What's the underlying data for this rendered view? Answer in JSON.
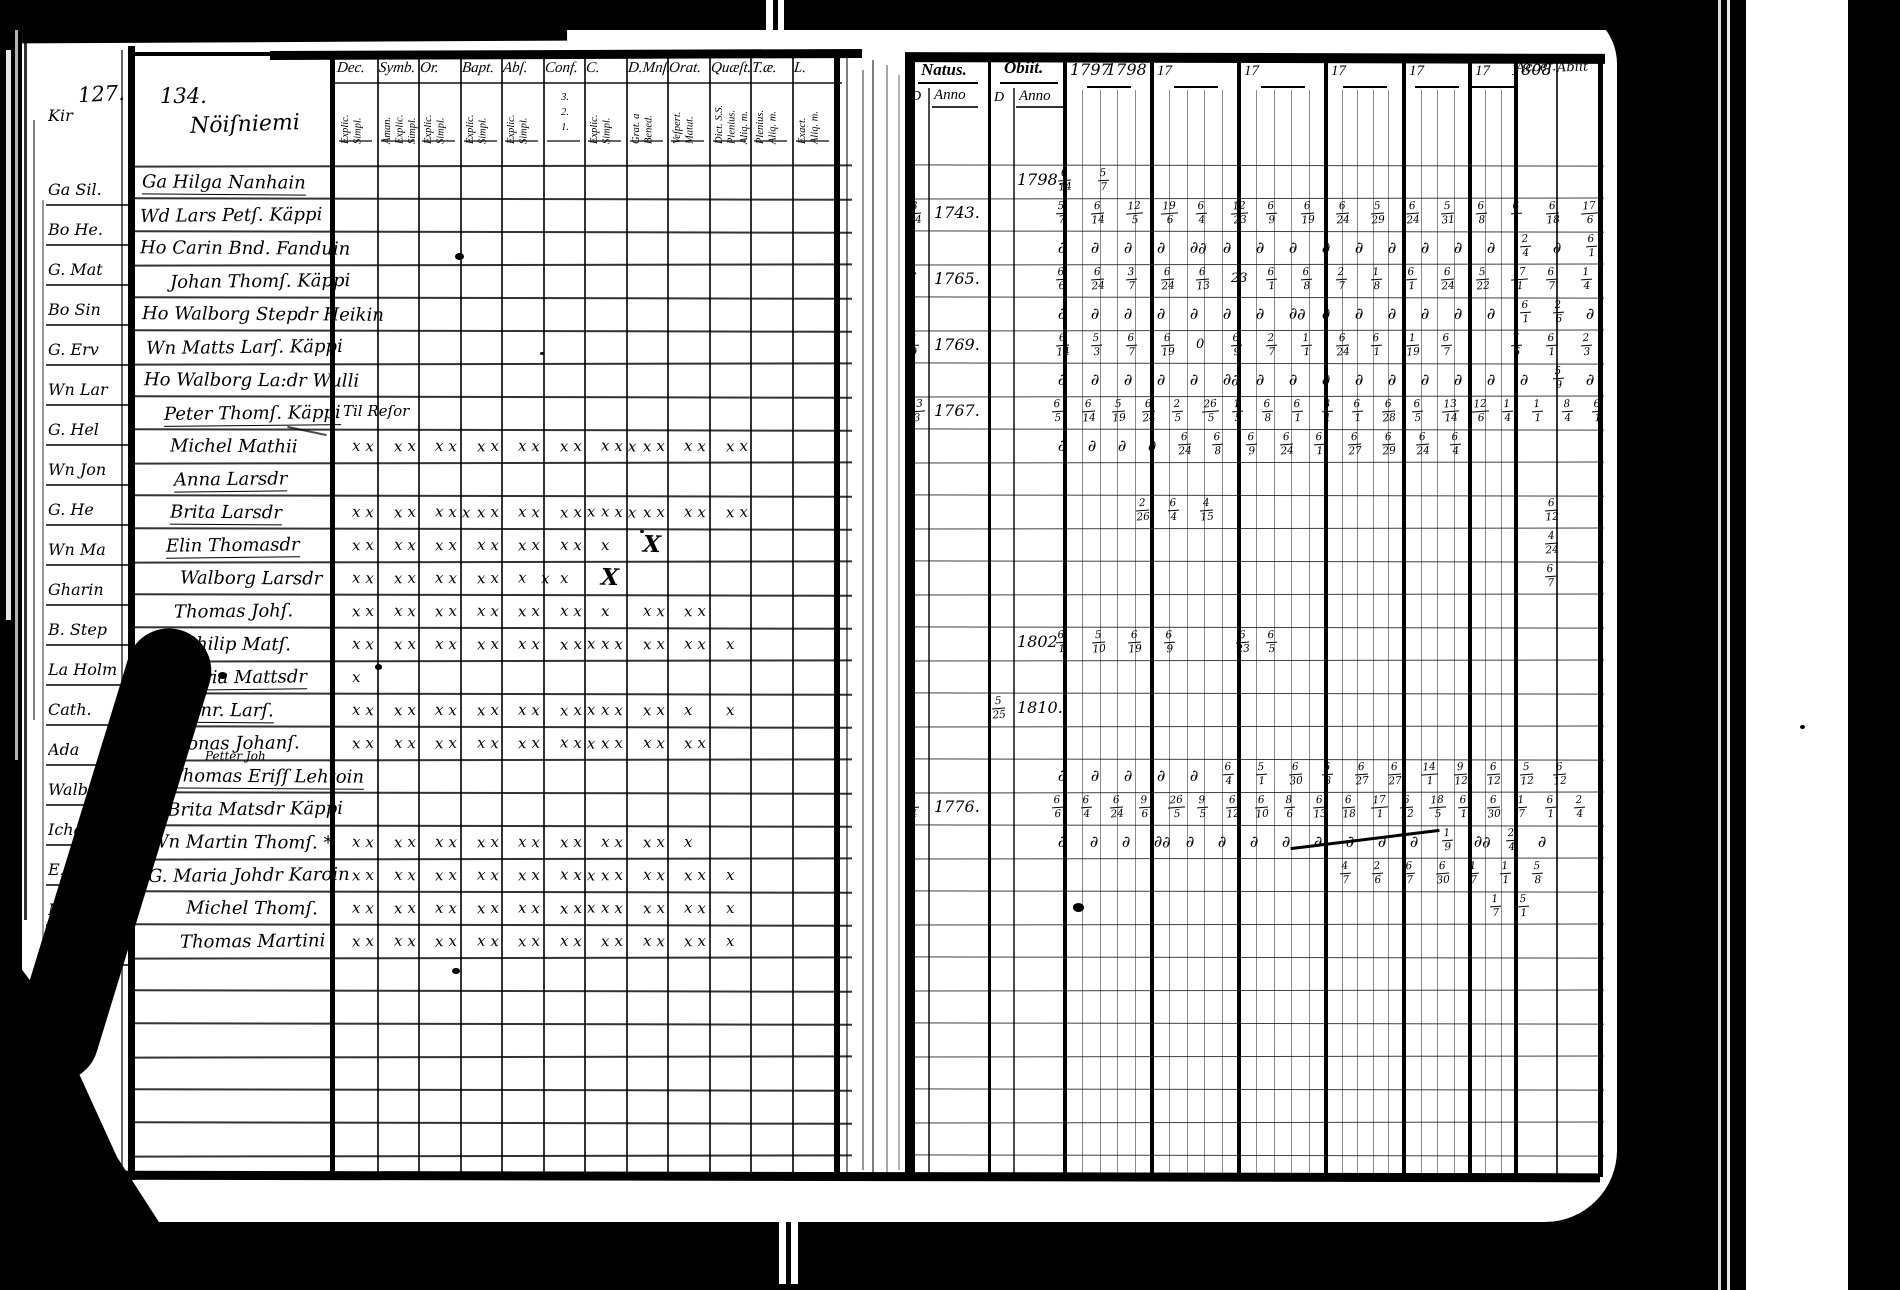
{
  "colors": {
    "paper": "#ffffff",
    "ink": "#000000"
  },
  "left_margin_fragments": [
    "Kir",
    "Ga Sil.",
    "Bo He.",
    "G. Mat",
    "Bo Sin",
    "G. Erv",
    "Wn Lar",
    "G. Hel",
    "Wn Jon",
    "G. He",
    "Wn Ma",
    "Gharin",
    "B. Step",
    "La Holm",
    "Cath.",
    "Ada",
    "Walbo",
    "Icha",
    "E.a",
    "Matt",
    "Siwo"
  ],
  "left_page": {
    "page_number_prev": "127.",
    "page_number": "134.",
    "title": "Nöiſniemi",
    "columns": [
      {
        "label": "Dec.",
        "sub": [
          "Explic.",
          "Simpl."
        ]
      },
      {
        "label": "Symb.",
        "sub": [
          "Åman.",
          "Explic.",
          "Simpl."
        ]
      },
      {
        "label": "Or.",
        "sub": [
          "Explic.",
          "Simpl."
        ]
      },
      {
        "label": "Bapt.",
        "sub": [
          "Explic.",
          "Simpl."
        ]
      },
      {
        "label": "Abſ.",
        "sub": [
          "Explic.",
          "Simpl."
        ]
      },
      {
        "label": "Conf.",
        "sub": [
          "3.",
          "2.",
          "1."
        ]
      },
      {
        "label": "C.",
        "sub": [
          "Explic.",
          "Simpl."
        ]
      },
      {
        "label": "D.Mnſ.",
        "sub": [
          "Grat. a",
          "Bened."
        ]
      },
      {
        "label": "Orat.",
        "sub": [
          "Veſpert.",
          "Matut."
        ]
      },
      {
        "label": "Quæſt.",
        "sub": [
          "Dict. S.S.",
          "Plenius.",
          "Aliq. m."
        ]
      },
      {
        "label": "T.æ.",
        "sub": [
          "Plenius.",
          "Aliq. m."
        ]
      },
      {
        "label": "L.",
        "sub": [
          "Exact.",
          "Aliq. m."
        ]
      }
    ],
    "rows": [
      {
        "name": "Ga Hilga Nanhain",
        "underline": true,
        "marks": []
      },
      {
        "name": "Wd Lars Petſ. Käppi",
        "marks": []
      },
      {
        "name": "Ho Carin Bnd. Fanduin",
        "marks": []
      },
      {
        "name": "Johan Thomſ. Käppi",
        "marks": []
      },
      {
        "name": "Ho Walborg Stepdr Heikin",
        "marks": []
      },
      {
        "name": "Wn Matts Larſ. Käppi",
        "marks": []
      },
      {
        "name": "Ho Walborg La:dr Wulli",
        "marks": []
      },
      {
        "name": "Peter Thomſ. Käppi",
        "underline": true,
        "note": "Til Reſor",
        "marks": []
      },
      {
        "name": "Michel Mathii",
        "marks": [
          "xx",
          "xx",
          "xx",
          "xx",
          "xx",
          "xx",
          "xxx",
          "xx",
          "xx",
          "xx"
        ]
      },
      {
        "name": "Anna Larsdr",
        "underline": true,
        "marks": []
      },
      {
        "name": "Brita Larsdr",
        "underline": true,
        "marks": [
          "xx",
          "xx",
          "xxx",
          "xx",
          "xx",
          "xxx",
          "xxx",
          "xx",
          "xx",
          "xx"
        ]
      },
      {
        "name": "Elin Thomasdr",
        "underline": true,
        "marks": [
          "xx",
          "xx",
          "xx",
          "xx",
          "xx",
          "xx",
          "x",
          "X",
          ""
        ]
      },
      {
        "name": "Walborg Larsdr",
        "marks": [
          "xx",
          "xx",
          "xx",
          "xx",
          "x x",
          "x",
          "X",
          ""
        ]
      },
      {
        "name": "Thomas Johſ.",
        "marks": [
          "xx",
          "xx",
          "xx",
          "xx",
          "xx",
          "xx",
          "x",
          "xx",
          "xx"
        ]
      },
      {
        "name": "Philip Matſ.",
        "marks": [
          "xx",
          "xx",
          "xx",
          "xx",
          "xx",
          "xxx",
          "xx",
          "xx",
          "xx",
          "x"
        ]
      },
      {
        "name": "Maria Mattsdr",
        "underline": true,
        "marks": [
          "x"
        ]
      },
      {
        "name": "Thonr. Larſ.",
        "underline": true,
        "marks": [
          "xx",
          "xx",
          "xx",
          "xx",
          "xx",
          "xxx",
          "xx",
          "xx",
          "x",
          "x"
        ]
      },
      {
        "name": "Jonas Johanſ.",
        "note2": "Petter Joh",
        "marks": [
          "xx",
          "xx",
          "xx",
          "xx",
          "xx",
          "xxx",
          "xx",
          "xx",
          "xx"
        ]
      },
      {
        "name": "B. Thomas Eriſſ Lehtoin",
        "underline": true,
        "marks": []
      },
      {
        "name": "G. Brita Matsdr Käppi",
        "marks": []
      },
      {
        "name": "Wn Martin Thomſ. *",
        "marks": [
          "xx",
          "xx",
          "xx",
          "xx",
          "xx",
          "xx",
          "xx",
          "xx",
          "x"
        ]
      },
      {
        "name": "G. Maria Johdr Karoin",
        "marks": [
          "xx",
          "xx",
          "xx",
          "xx",
          "xx",
          "xxx",
          "xx",
          "xx",
          "xx",
          "x"
        ]
      },
      {
        "name": "Michel Thomſ.",
        "marks": [
          "xx",
          "xx",
          "xx",
          "xx",
          "xx",
          "xxx",
          "xx",
          "xx",
          "xx",
          "x"
        ]
      },
      {
        "name": "Thomas Martini",
        "marks": [
          "xx",
          "xx",
          "xx",
          "xx",
          "xx",
          "xx",
          "xx",
          "xx",
          "xx",
          "x"
        ]
      }
    ]
  },
  "right_page": {
    "natus_label": "Natus.",
    "obiit_label": "Obiit.",
    "day_label": "D",
    "anno_label": "Anno",
    "year_headers": [
      "1797|1798",
      "17",
      "17",
      "17",
      "17",
      "17|1808"
    ],
    "accessit_label": "Accef.",
    "abiit_label": "Abiit",
    "rows": [
      {
        "obiit_anno": "1798.",
        "runs": [
          {
            "x": 1058,
            "p": 40,
            "t": [
              "6/14",
              "5/7"
            ]
          }
        ]
      },
      {
        "natus_d": "8/14",
        "natus_anno": "1743.",
        "runs": [
          {
            "x": 1056,
            "p": 35,
            "t": [
              "5/7",
              "6/14",
              "12/5",
              "19/6",
              "6/4",
              "12/23",
              "6/9",
              "6/19",
              "6/24",
              "5/29",
              "6/24",
              "5/31",
              "6/8",
              "6/1",
              "6/18",
              "17/6"
            ]
          }
        ]
      },
      {
        "runs": [
          {
            "x": 1058,
            "p": 33,
            "t": [
              "∂",
              "∂",
              "∂",
              "∂",
              "∂∂",
              "∂",
              "∂",
              "∂",
              "∂",
              "∂",
              "∂",
              "∂",
              "∂",
              "∂",
              "2/4",
              "∂",
              "6/1"
            ]
          }
        ]
      },
      {
        "natus_d": "7",
        "natus_anno": "1765.",
        "runs": [
          {
            "x": 1056,
            "p": 35,
            "t": [
              "6/6",
              "6/24",
              "3/7",
              "6/24",
              "6/13",
              "23",
              "6/1",
              "6/8",
              "2/7",
              "1/8",
              "6/1",
              "6/24",
              "5/22",
              "17/1",
              "6/7",
              "1/4"
            ]
          }
        ]
      },
      {
        "runs": [
          {
            "x": 1058,
            "p": 33,
            "t": [
              "∂",
              "∂",
              "∂",
              "∂",
              "∂",
              "∂",
              "∂",
              "∂∂",
              "∂",
              "∂",
              "∂",
              "∂",
              "∂",
              "∂",
              "6/1",
              "2/6",
              "∂"
            ]
          }
        ]
      },
      {
        "natus_d": "2/9",
        "natus_anno": "1769.",
        "runs": [
          {
            "x": 1056,
            "p": 35,
            "t": [
              "6/14",
              "5/3",
              "6/7",
              "6/19",
              "0",
              "6/9",
              "2/7",
              "1/1",
              "6/24",
              "6/1",
              "1/19",
              "6/7",
              "",
              "7/6",
              "6/1",
              "2/3"
            ]
          }
        ]
      },
      {
        "runs": [
          {
            "x": 1058,
            "p": 33,
            "t": [
              "∂",
              "∂",
              "∂",
              "∂",
              "∂",
              "∂∂",
              "∂",
              "∂",
              "∂",
              "∂",
              "∂",
              "∂",
              "∂",
              "∂",
              "∂",
              "5/9",
              "∂"
            ]
          }
        ]
      },
      {
        "natus_d": "13/3",
        "natus_anno": "1767.",
        "runs": [
          {
            "x": 1052,
            "p": 30,
            "t": [
              "6/5",
              "6/14",
              "5/19",
              "6/24",
              "2/5",
              "26/5",
              "1/5",
              "6/8",
              "6/1",
              "8/1",
              "6/1",
              "6/28",
              "6/5",
              "13/14",
              "12/6",
              "1/4",
              "1/1",
              "8/4",
              "6/1"
            ]
          }
        ]
      },
      {
        "runs": [
          {
            "x": 1058,
            "p": 30,
            "t": [
              "∂",
              "∂",
              "∂",
              "∂"
            ]
          },
          {
            "x": 1178,
            "p": 34,
            "t": [
              "6/24",
              "6/8",
              "6/9",
              "6/24",
              "6/1",
              "6/27",
              "6/29",
              "6/24",
              "6/4"
            ]
          }
        ]
      },
      {
        "runs": []
      },
      {
        "runs": [
          {
            "x": 1136,
            "p": 32,
            "t": [
              "2/26",
              "6/4",
              "4/15"
            ]
          },
          {
            "x": 1545,
            "p": 30,
            "t": [
              "6/12"
            ]
          }
        ]
      },
      {
        "runs": [
          {
            "x": 1545,
            "p": 30,
            "t": [
              "4/24"
            ]
          }
        ]
      },
      {
        "runs": [
          {
            "x": 1545,
            "p": 30,
            "t": [
              "6/7"
            ]
          }
        ]
      },
      {
        "runs": []
      },
      {
        "obiit_anno": "1802",
        "runs": [
          {
            "x": 1056,
            "p": 36,
            "t": [
              "6/1",
              "5/10",
              "6/19",
              "6/9"
            ]
          },
          {
            "x": 1236,
            "p": 30,
            "t": [
              "6/23",
              "6/5"
            ]
          }
        ]
      },
      {
        "runs": []
      },
      {
        "obiit_d": "5/25",
        "obiit_anno": "1810.",
        "runs": []
      },
      {
        "runs": []
      },
      {
        "runs": [
          {
            "x": 1058,
            "p": 33,
            "t": [
              "∂",
              "∂",
              "∂",
              "∂",
              "∂",
              "6/4",
              "5/1",
              "6/30",
              "6/8",
              "6/27",
              "6/27",
              "14/1",
              "9/12",
              "6/12",
              "5/12",
              "6/12"
            ]
          }
        ]
      },
      {
        "natus_d": "4/4",
        "natus_anno": "1776.",
        "runs": [
          {
            "x": 1052,
            "p": 29,
            "t": [
              "6/6",
              "6/4",
              "6/24",
              "9/6",
              "26/5",
              "9/5",
              "6/12",
              "6/10",
              "8/6",
              "6/13",
              "6/18",
              "17/1",
              "6/12",
              "18/5",
              "6/1",
              "6/30",
              "1/7",
              "6/1",
              "2/4"
            ]
          }
        ]
      },
      {
        "runs": [
          {
            "x": 1058,
            "p": 32,
            "t": [
              "∂",
              "∂",
              "∂",
              "∂∂",
              "∂",
              "∂",
              "∂",
              "∂",
              "∂",
              "∂",
              "∂",
              "∂",
              "1/9",
              "∂∂",
              "2/4",
              "∂"
            ]
          }
        ]
      },
      {
        "runs": [
          {
            "x": 1340,
            "p": 32,
            "t": [
              "4/7",
              "2/6",
              "6/7",
              "6/30",
              "1/7",
              "1/1",
              "5/8"
            ]
          }
        ]
      },
      {
        "runs": [
          {
            "x": 1490,
            "p": 28,
            "t": [
              "1/7",
              "5/1"
            ]
          }
        ]
      },
      {
        "runs": []
      }
    ]
  }
}
